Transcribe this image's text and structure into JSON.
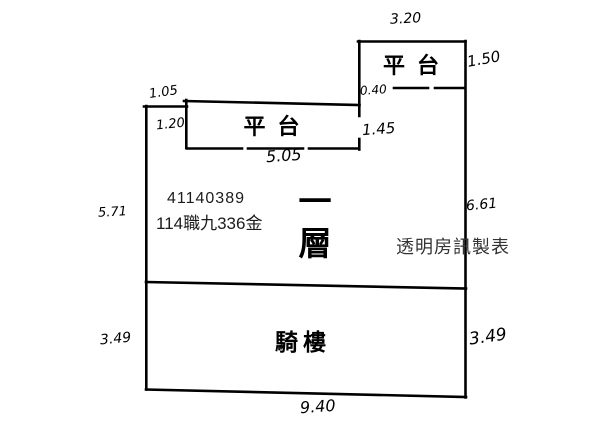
{
  "canvas": {
    "background": "#ffffff",
    "ink": "#000000"
  },
  "plan": {
    "unit_labels": {
      "platform_top": "平台",
      "platform_left": "平台",
      "floor_vertical": "一層",
      "arcade": "騎樓"
    },
    "annotations": {
      "case_number": "41140389",
      "case_reference": "114職九336金",
      "watermark": "透明房訊製表"
    },
    "dimensions": {
      "platform_top_width": "3.20",
      "platform_top_height": "1.50",
      "platform_top_offset": "0.40",
      "notch_width": "1.05",
      "platform_left_left_height": "1.20",
      "platform_left_right_height": "1.45",
      "platform_left_width": "5.05",
      "floor_left_height": "5.71",
      "floor_right_height": "6.61",
      "arcade_left_height": "3.49",
      "arcade_right_height": "3.49",
      "bottom_width": "9.40"
    }
  }
}
